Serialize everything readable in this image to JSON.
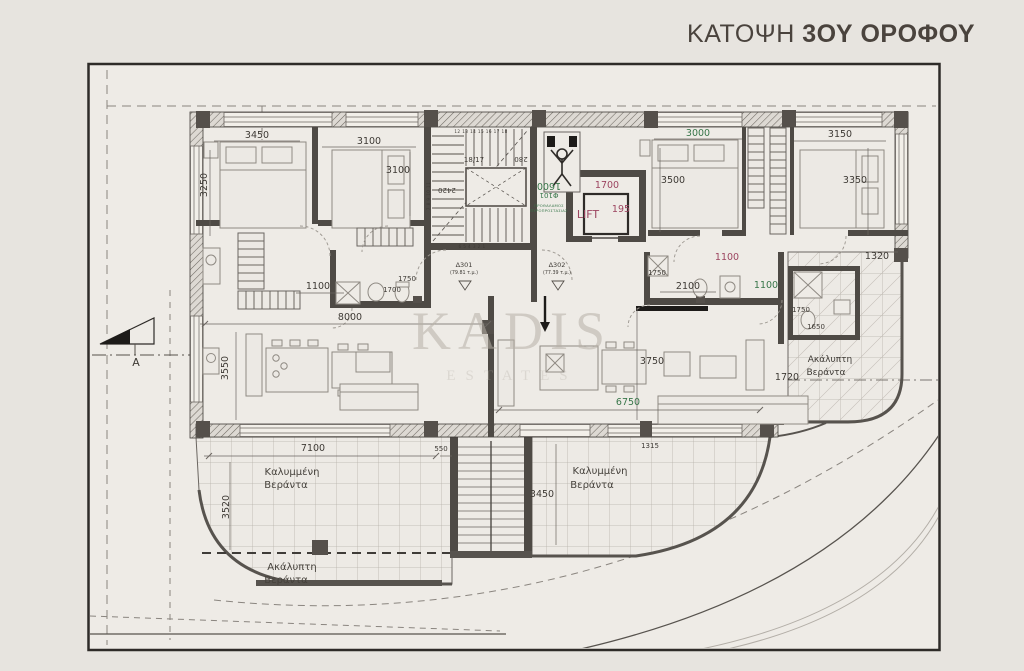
{
  "title": {
    "regular": "ΚΑΤΟΨΗ ",
    "bold": "3ΟΥ ΟΡΟΦΟΥ"
  },
  "watermark": {
    "main": "KADIS",
    "sub": "ESTATES"
  },
  "section_marker": "A",
  "units": {
    "d301": {
      "id": "Δ301",
      "area": "(79.81 τ.μ.)"
    },
    "d302": {
      "id": "Δ302",
      "area": "(77.39 τ.μ.)"
    }
  },
  "lift": {
    "width": "1700",
    "depth": "195",
    "label": "LIFT"
  },
  "lobby": {
    "dim": "1600",
    "door": "Φ101",
    "note1": "ΠΡΟΘΑΛΑΜΟΣ",
    "note2": "ΠΥΡΟΠΡΟΣΤΑΣΙΑΣ"
  },
  "stairs": {
    "top_numbers": "12 13 14 15 16 17 18",
    "bottom_numbers": "6 5 4 3 2 1",
    "side_numbers": "7 8 9 10 11",
    "count_label": "18/17",
    "riser": "280",
    "width": "2420"
  },
  "verandas": {
    "covered_line1": "Καλυμμένη",
    "covered_line2": "Βεράντα",
    "uncovered_line1": "Ακάλυπτη",
    "uncovered_line2": "Βεράντα"
  },
  "dims": {
    "bed1_width": "3450",
    "bed1_depth": "3250",
    "bed2_width": "3100",
    "bed2_depth": "3100",
    "bed3_width": "3000",
    "bed3_depth": "3500",
    "bed4_width": "3150",
    "bed4_depth": "3350",
    "left_hall": "1100",
    "left_bath_a": "1750",
    "left_bath_b": "1700",
    "left_living_width": "8000",
    "left_living_depth": "3550",
    "right_bath_width": "2100",
    "right_bath_a": "1750",
    "right_bath_door": "1100",
    "right_hall": "1100",
    "right_corner": "1320",
    "right_wc_a": "1750",
    "right_wc_b": "1650",
    "right_veranda_depth": "1720",
    "center_living_depth": "3750",
    "center_living_width": "6750",
    "left_veranda_width": "7100",
    "left_veranda_step": "550",
    "left_veranda_depth": "3520",
    "mid_veranda_depth": "3450",
    "mid_veranda_step": "1315"
  },
  "colors": {
    "ink": "#3e3a35",
    "dimension_green": "#38764a",
    "dimension_red": "#9c4560",
    "paper": "#eeebe6",
    "background": "#e7e4df",
    "frame": "#2e2b28"
  }
}
